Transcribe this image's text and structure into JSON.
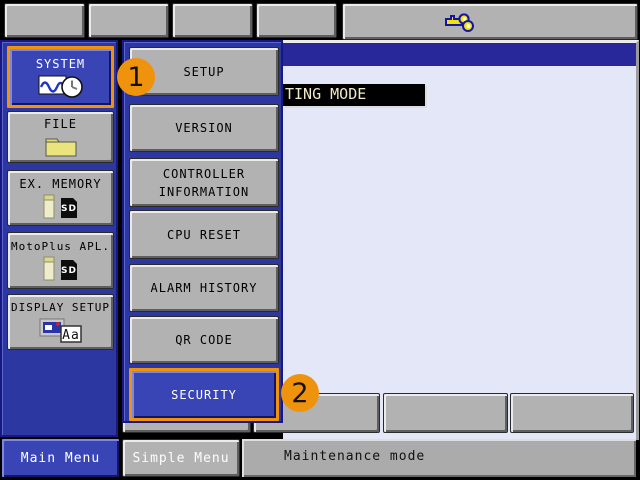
{
  "top_bar": {
    "buttons": [
      "",
      "",
      "",
      ""
    ],
    "utility": {
      "icon": "keys-icon"
    }
  },
  "sidebar": {
    "items": [
      {
        "label": "SYSTEM",
        "icon": "chart-clock-icon",
        "selected": true
      },
      {
        "label": "FILE",
        "icon": "folder-icon",
        "selected": false
      },
      {
        "label": "EX. MEMORY",
        "icon": "usb-sd-icon",
        "selected": false
      },
      {
        "label": "MotoPlus APL.",
        "icon": "usb-sd-icon",
        "selected": false
      },
      {
        "label": "DISPLAY SETUP",
        "icon": "window-aa-icon",
        "selected": false
      }
    ]
  },
  "menu": {
    "items": [
      {
        "label": "SETUP",
        "selected": false
      },
      {
        "label": "VERSION",
        "selected": false
      },
      {
        "label": "CONTROLLER INFORMATION",
        "selected": false
      },
      {
        "label": "CPU RESET",
        "selected": false
      },
      {
        "label": "ALARM HISTORY",
        "selected": false
      },
      {
        "label": "QR CODE",
        "selected": false
      },
      {
        "label": "SECURITY",
        "selected": true
      }
    ]
  },
  "content": {
    "mode_banner": "TING MODE"
  },
  "function_keys": [
    "",
    "",
    "",
    ""
  ],
  "bottom_bar": {
    "main_menu_label": "Main Menu",
    "simple_menu_label": "Simple Menu",
    "status_text": "Maintenance mode"
  },
  "badges": [
    {
      "label": "1"
    },
    {
      "label": "2"
    }
  ],
  "colors": {
    "accent_orange": "#F0930C",
    "panel_blue": "#2C37A2",
    "selected_blue": "#3A45B5",
    "title_band_blue": "#28289B",
    "content_bg": "#E3E7F8",
    "banner_bg": "#000000",
    "banner_text": "#F0EAC6",
    "button_gray": "#B2B2B2"
  }
}
